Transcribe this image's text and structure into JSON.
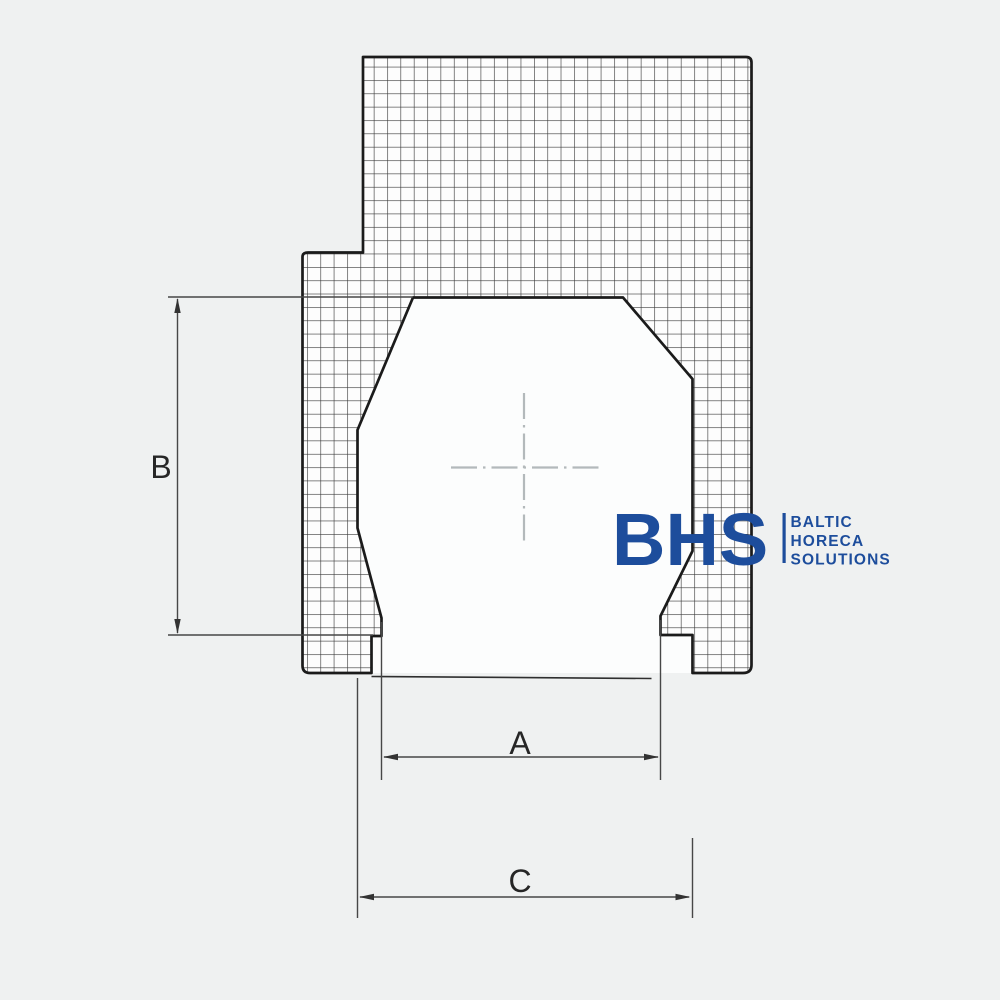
{
  "drawing": {
    "title": "technical cross-section of appliance with open bottom door",
    "dimension_labels": {
      "a": "A",
      "b": "B",
      "c": "C"
    },
    "label_color": "#262626",
    "outline_color": "#1b1b1b",
    "dim_line_color": "#474747",
    "centerline_color": "#b3b9bb",
    "body_fill": "#fdfdfd"
  },
  "logo": {
    "monogram": "BHS",
    "line1": "BALTIC",
    "line2": "HORECA",
    "line3": "SOLUTIONS",
    "color": "#1d4d9c"
  }
}
